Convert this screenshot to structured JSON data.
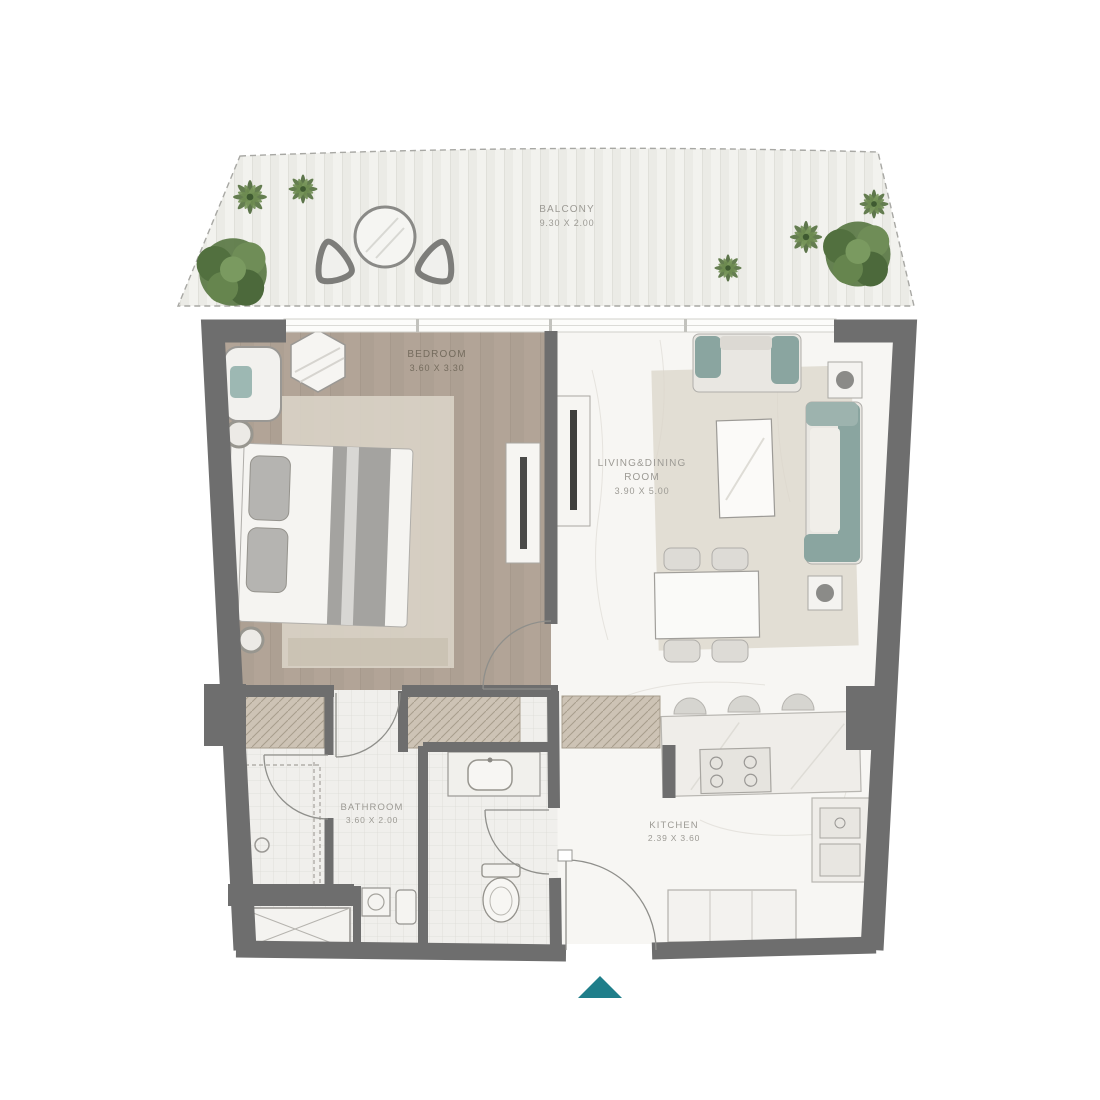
{
  "plan": {
    "description": "One-bedroom apartment floor plan with balcony",
    "rooms": {
      "balcony": {
        "name": "BALCONY",
        "dims": "9.30 X 2.00"
      },
      "bedroom": {
        "name": "BEDROOM",
        "dims": "3.60 X 3.30"
      },
      "living": {
        "name_line1": "LIVING&DINING",
        "name_line2": "ROOM",
        "dims": "3.90 X 5.00"
      },
      "bathroom": {
        "name": "BATHROOM",
        "dims": "3.60 X 2.00"
      },
      "kitchen": {
        "name": "KITCHEN",
        "dims": "2.39 X 3.60"
      }
    },
    "entrance": {
      "marker": "triangle-up"
    },
    "colors": {
      "wall": "#6e6e6e",
      "entrance_arrow": "#1f7e8a",
      "sofa_teal": "#8aa5a0",
      "bedroom_wood": "#b2a497",
      "rug": "#d9d3c7",
      "plant_green": "#5e7b49"
    }
  }
}
